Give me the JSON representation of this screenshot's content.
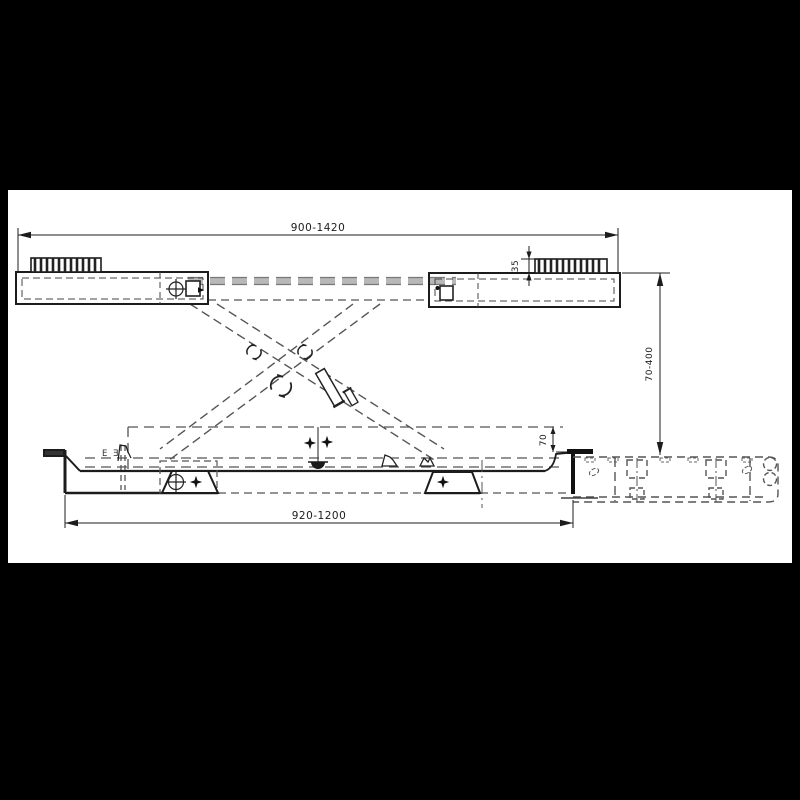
{
  "dimensions": {
    "platform_length": {
      "label": "900-1420"
    },
    "pad_height": {
      "label": "35"
    },
    "lift_height_range": {
      "label": "70-400"
    },
    "base_channel_height": {
      "label": "70"
    },
    "base_length": {
      "label": "920-1200"
    }
  },
  "detail_marks": {
    "pair": "E Ǝ"
  },
  "symbols": [
    "pivot-rotation",
    "position-target",
    "star-marker",
    "grease-cup",
    "ribbed-rubber-pad"
  ],
  "colors": {
    "background": "#000000",
    "sheet": "#ffffff",
    "solid_line": "#1c1c1c",
    "hidden_line": "#555555",
    "slide_band": "#a9a9a9"
  }
}
